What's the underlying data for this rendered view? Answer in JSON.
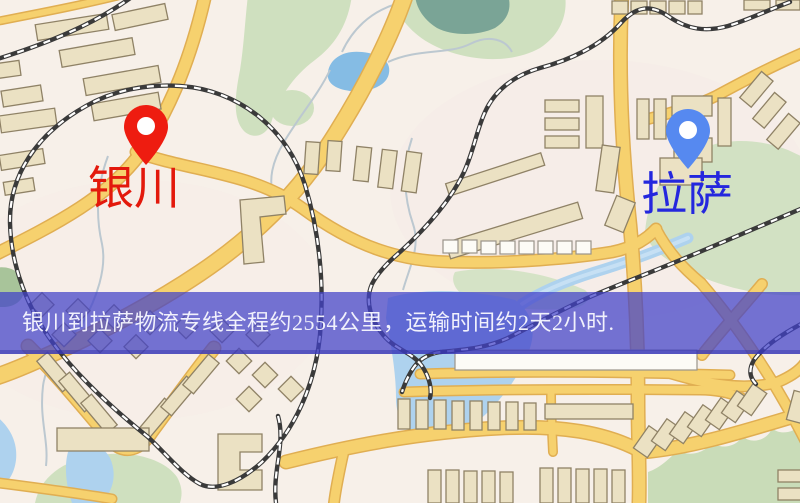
{
  "page": {
    "type": "logistics-route-map"
  },
  "markers": [
    {
      "name": "origin",
      "label": "银川",
      "pin_color": "#ee1c10",
      "label_color": "#e3190c"
    },
    {
      "name": "destination",
      "label": "拉萨",
      "pin_color": "#5689f0",
      "label_color": "#2427de"
    }
  ],
  "banner": {
    "text": "银川到拉萨物流专线全程约2554公里，运输时间约2天2小时.",
    "bg_color": "rgba(66,66,200,0.73)",
    "text_color": "#f1f1fc"
  },
  "map_colors": {
    "background": "#f7f0e9",
    "road": "#f6d16e",
    "road_casing": "#e0ae52",
    "building": "#ebe1c3",
    "park_green": "#cfe0bf",
    "pond_green": "#7aa496",
    "water": "#aed2ee",
    "lake": "#85bce4",
    "railway": "#3a3a3a"
  }
}
